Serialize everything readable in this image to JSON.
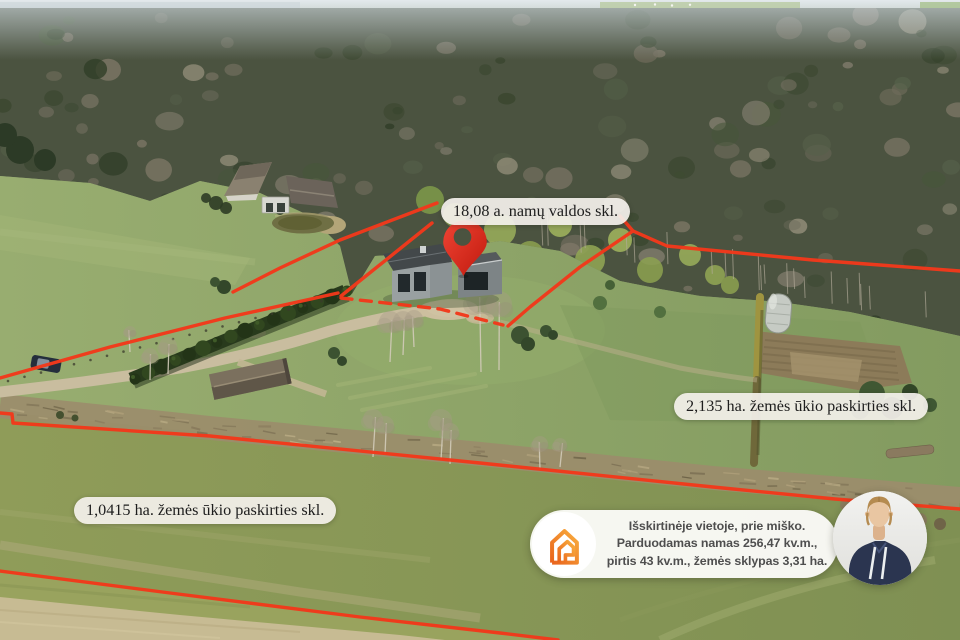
{
  "parcel_labels": [
    {
      "id": "homestead",
      "text": "18,08 a. namų valdos skl."
    },
    {
      "id": "farmland-large",
      "text": "2,135 ha. žemės ūkio paskirties skl."
    },
    {
      "id": "farmland-small",
      "text": "1,0415 ha. žemės ūkio paskirties skl."
    }
  ],
  "info_card": {
    "icon": "house-logo-icon",
    "lines": [
      "Išskirtinėje vietoje, prie miško.",
      "Parduodamas namas 256,47 kv.m.,",
      "pirtis 43 kv.m., žemės sklypas 3,31 ha."
    ]
  },
  "markers": {
    "pin_icon": "location-pin-icon",
    "agent_avatar": "agent-photo"
  },
  "colors": {
    "boundary_red": "#f2391b",
    "brand_orange": "#f08023",
    "pin_red": "#e02a1c"
  }
}
